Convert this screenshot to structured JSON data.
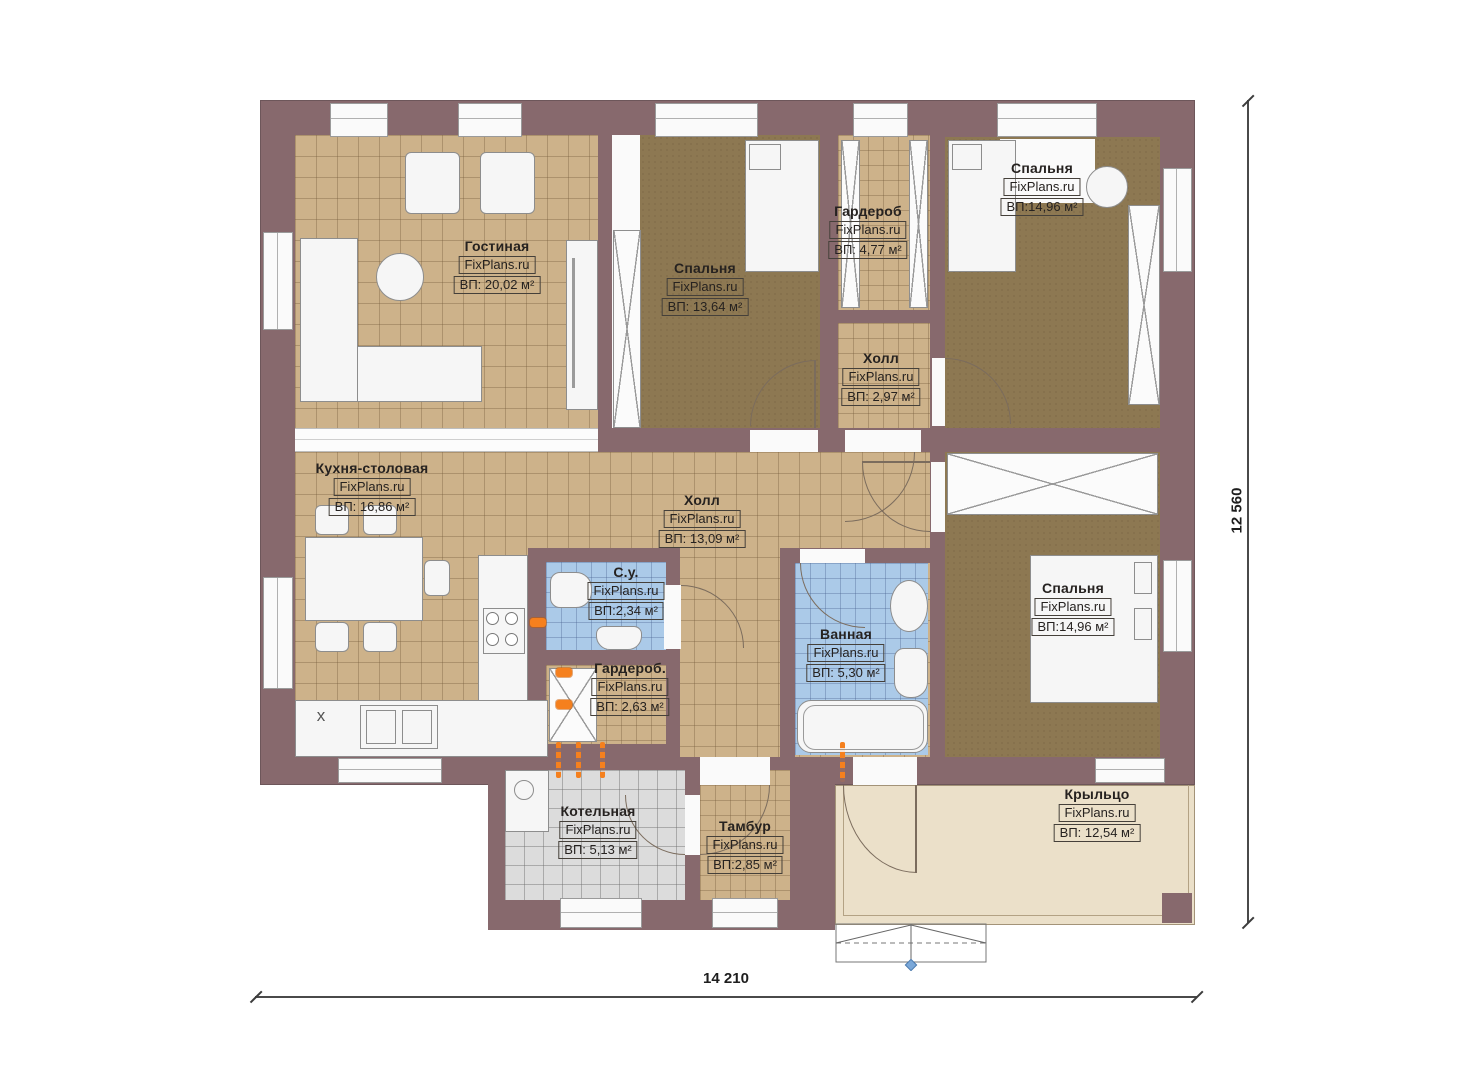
{
  "plan": {
    "watermark": "FixPlans.ru",
    "rooms": [
      {
        "name": "Гостиная",
        "area": "ВП: 20,02 м²"
      },
      {
        "name": "Спальня",
        "area": "ВП: 13,64 м²"
      },
      {
        "name": "Гардероб",
        "area": "ВП: 4,77 м²"
      },
      {
        "name": "Спальня",
        "area": "ВП:14,96 м²"
      },
      {
        "name": "Холл",
        "area": "ВП: 2,97 м²"
      },
      {
        "name": "Кухня-столовая",
        "area": "ВП: 16,86 м²"
      },
      {
        "name": "Холл",
        "area": "ВП: 13,09 м²"
      },
      {
        "name": "С.у.",
        "area": "ВП:2,34 м²"
      },
      {
        "name": "Гардероб.",
        "area": "ВП: 2,63 м²"
      },
      {
        "name": "Ванная",
        "area": "ВП: 5,30 м²"
      },
      {
        "name": "Спальня",
        "area": "ВП:14,96 м²"
      },
      {
        "name": "Котельная",
        "area": "ВП: 5,13 м²"
      },
      {
        "name": "Тамбур",
        "area": "ВП:2,85 м²"
      },
      {
        "name": "Крыльцо",
        "area": "ВП: 12,54 м²"
      }
    ],
    "dimensions": {
      "width": "14 210",
      "height": "12 560"
    },
    "marks": {
      "kitchen_x": "x"
    },
    "colors": {
      "wall": "#87696d",
      "floor_light": "#cdb28a",
      "floor_dark": "#8d7852",
      "floor_wet": "#abcae8",
      "floor_boiler": "#dcdcdc",
      "porch": "#ebe0c9",
      "accent": "#f5801e"
    }
  }
}
